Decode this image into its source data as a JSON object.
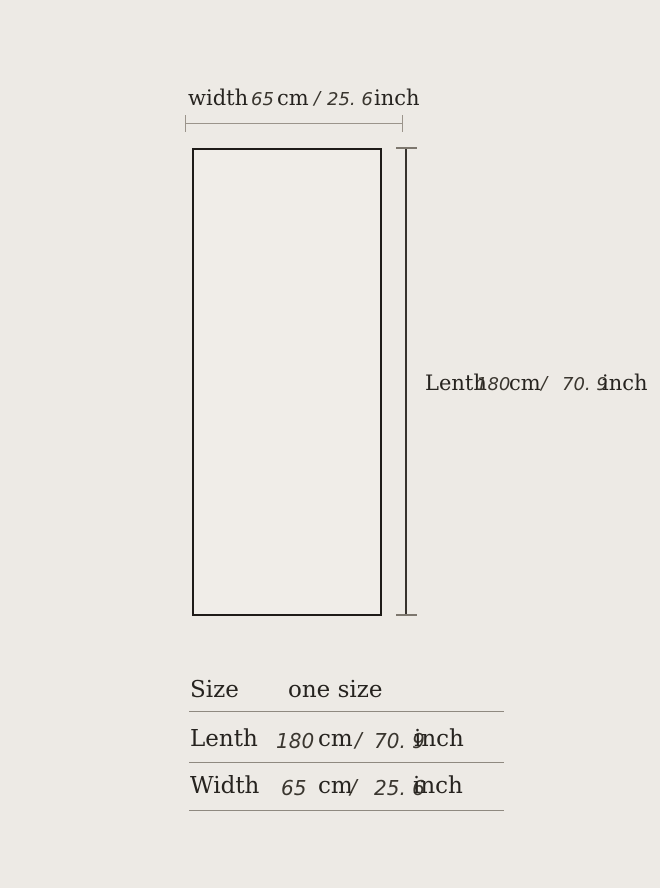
{
  "colors": {
    "bg": "#edeae5",
    "ink": "#26231f",
    "outline": "#1e1b18",
    "dim-gray": "#9b948b",
    "dim-dark": "#37332e",
    "rule": "#8f8980"
  },
  "diagram": {
    "width_label": {
      "word": "width",
      "cm_num": "65",
      "cm_unit": "cm",
      "slash": "/",
      "inch_num": "25. 6",
      "inch_unit": "inch"
    },
    "length_label": {
      "word": "Lenth",
      "cm_num": "180",
      "cm_unit": "cm",
      "slash": "/",
      "inch_num": "70. 9",
      "inch_unit": "inch"
    }
  },
  "table": {
    "size_row": {
      "label": "Size",
      "value": "one size"
    },
    "length_row": {
      "label": "Lenth",
      "cm_num": "180",
      "cm_unit": "cm",
      "slash": "/",
      "inch_num": "70. 9",
      "inch_unit": "inch"
    },
    "width_row": {
      "label": "Width",
      "cm_num": "65",
      "cm_unit": "cm",
      "slash": "/",
      "inch_num": "25. 6",
      "inch_unit": "inch"
    }
  }
}
